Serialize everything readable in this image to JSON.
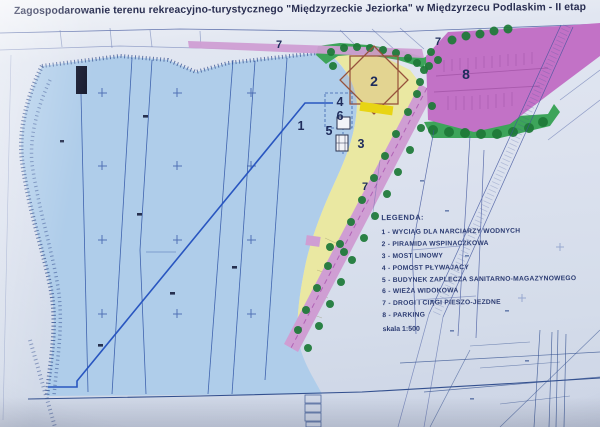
{
  "photo": {
    "title": "Zagospodarowanie terenu rekreacyjno-turystycznego  \"Międzyrzeckie Jeziorka\" w Międzyrzecu Podlaskim - II etap"
  },
  "legend": {
    "heading": "LEGENDA:",
    "items": [
      "1 - WYCIĄG DLA NARCIARZY WODNYCH",
      "2 - PIRAMIDA WSPINACZKOWA",
      "3 - MOST LINOWY",
      "4 - POMOST PŁYWAJĄCY",
      "5 - BUDYNEK ZAPLECZA SANITARNO-MAGAZYNOWEGO",
      "6 - WIEŻA WIDOKOWA",
      "7 - DROGI I CIĄGI PIESZO-JEZDNE",
      "8 - PARKING"
    ],
    "scale": "skala 1:500"
  },
  "markers": {
    "m1": "1",
    "m2": "2",
    "m3": "3",
    "m4": "4",
    "m5": "5",
    "m6": "6",
    "m7": "7",
    "m8": "8"
  },
  "colors": {
    "water": "#afcdea",
    "beach": "#eae8a2",
    "grass": "#3da45a",
    "tree": "#1e7a38",
    "path": "#cf9ed3",
    "parking": "#c272c6",
    "highlight": "#e8d414",
    "pyr": "#96523c",
    "line": "#2f55a8",
    "ink": "#1f2c5c"
  }
}
